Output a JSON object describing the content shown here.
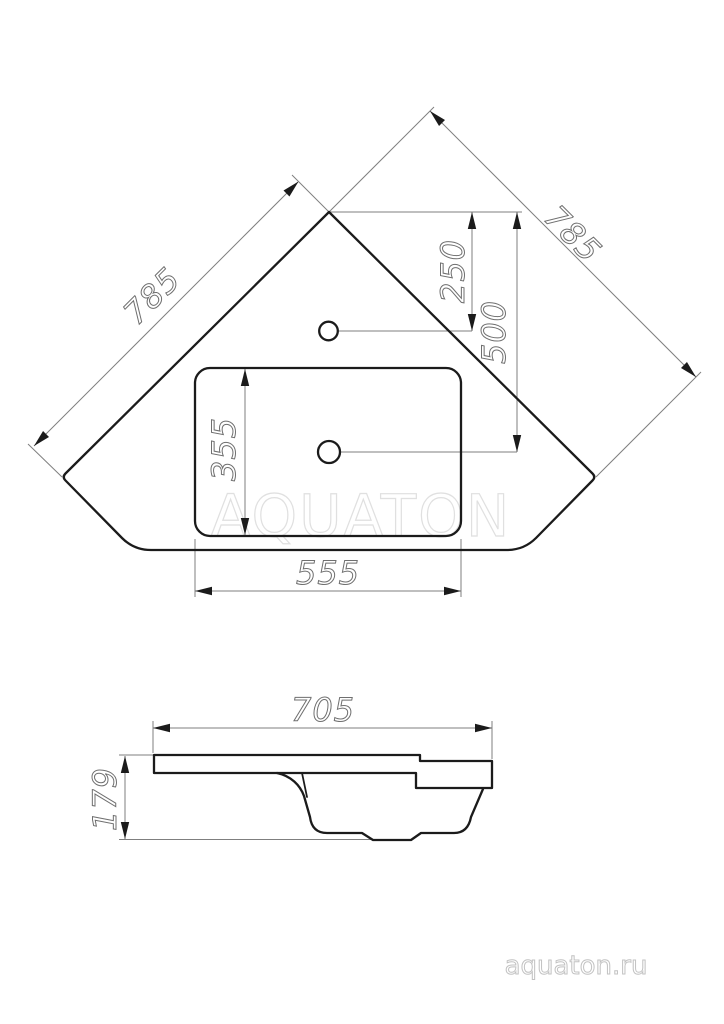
{
  "drawing": {
    "watermark": "AQUATON",
    "website": "aquaton.ru",
    "top_view": {
      "dim_side_left": "785",
      "dim_side_right": "785",
      "dim_faucet_hole_offset": "250",
      "dim_drain_hole_offset": "500",
      "dim_basin_depth": "355",
      "dim_basin_width": "555"
    },
    "side_view": {
      "dim_width": "705",
      "dim_height": "179"
    },
    "colors": {
      "outline": "#1b1b1b",
      "dimension": "#7f7f7f",
      "dim_text": "#6f6f6f",
      "watermark": "#e0e0e0",
      "website": "#c2c2c2"
    }
  }
}
